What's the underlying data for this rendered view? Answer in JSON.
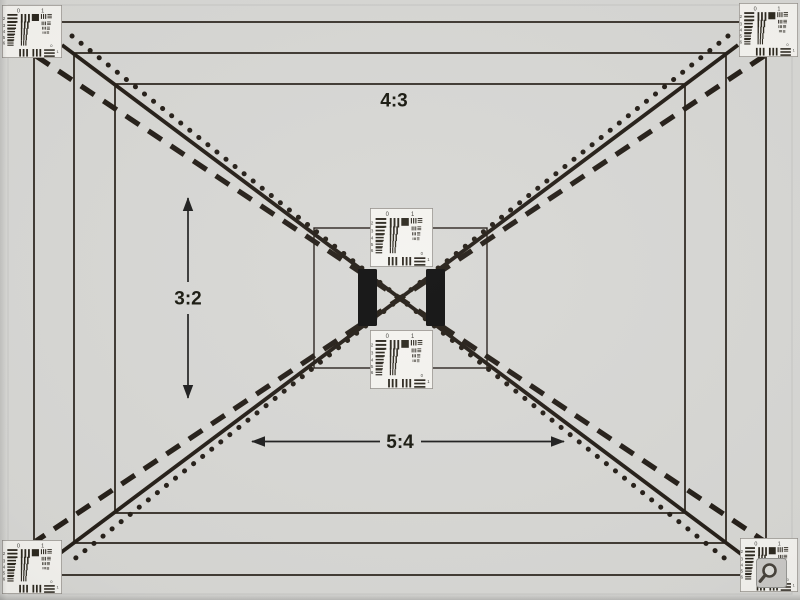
{
  "aspect_labels": {
    "top_frame": "4:3",
    "left_arrow": "3:2",
    "bottom_arrow": "5:4"
  },
  "resolution_chart": {
    "top_labels": [
      "0",
      "1"
    ],
    "row_labels": [
      "2",
      "3",
      "4",
      "5",
      "6"
    ],
    "side_labels": [
      "0",
      "1"
    ]
  },
  "icons": {
    "zoom_cursor": "magnifier-icon"
  },
  "colors": {
    "background": "#d7d7d4",
    "ink": "#241b12",
    "chart_paper": "#f4f3ef",
    "chart_ink": "#2b261f",
    "chart_text": "#3f3e39",
    "center_bar": "#0d0a08",
    "zoom_button_bg": "#cac9c6",
    "zoom_glass": "#454039"
  }
}
